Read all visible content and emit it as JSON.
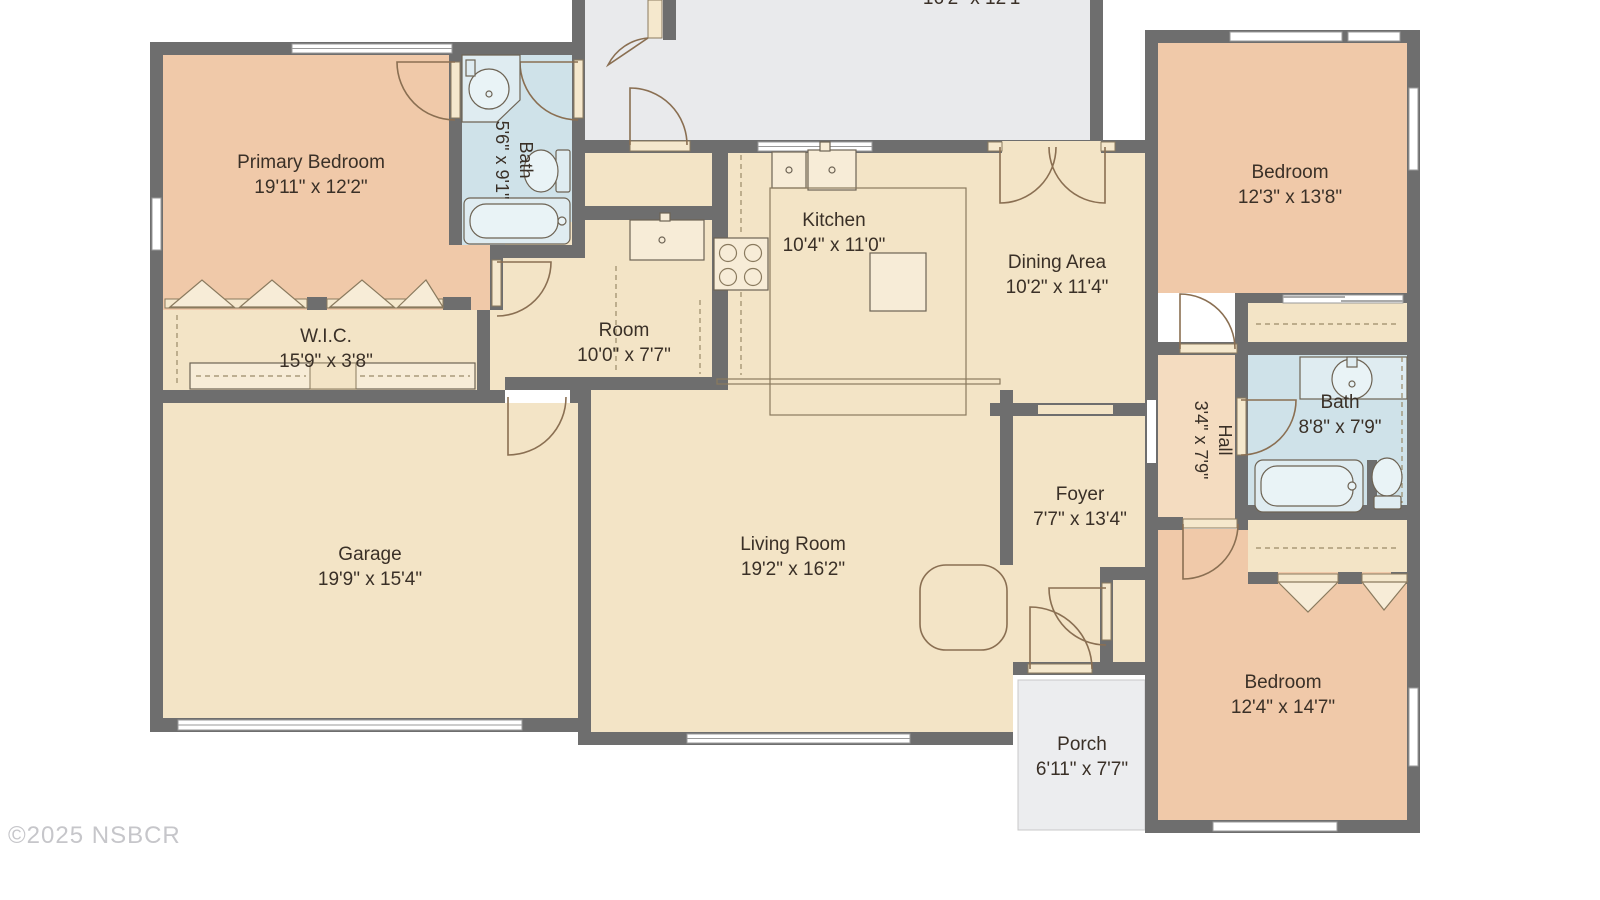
{
  "rooms": {
    "upper_room_partial": {
      "dims": "16'2\" x 12'1\""
    },
    "primary_bedroom": {
      "name": "Primary Bedroom",
      "dims": "19'11\" x 12'2\""
    },
    "bath_1": {
      "name": "Bath",
      "dims": "5'6\" x 9'1\""
    },
    "kitchen": {
      "name": "Kitchen",
      "dims": "10'4\" x 11'0\""
    },
    "dining_area": {
      "name": "Dining Area",
      "dims": "10'2\" x 11'4\""
    },
    "bedroom_2": {
      "name": "Bedroom",
      "dims": "12'3\" x 13'8\""
    },
    "wic": {
      "name": "W.I.C.",
      "dims": "15'9\" x 3'8\""
    },
    "room": {
      "name": "Room",
      "dims": "10'0\" x 7'7\""
    },
    "hall": {
      "name": "Hall",
      "dims": "3'4\" x 7'9\""
    },
    "bath_2": {
      "name": "Bath",
      "dims": "8'8\" x 7'9\""
    },
    "garage": {
      "name": "Garage",
      "dims": "19'9\" x 15'4\""
    },
    "living_room": {
      "name": "Living Room",
      "dims": "19'2\" x 16'2\""
    },
    "foyer": {
      "name": "Foyer",
      "dims": "7'7\" x 13'4\""
    },
    "bedroom_3": {
      "name": "Bedroom",
      "dims": "12'4\" x 14'7\""
    },
    "porch": {
      "name": "Porch",
      "dims": "6'11\" x 7'7\""
    }
  },
  "footer": {
    "copyright": "©2025 NSBCR"
  },
  "colors": {
    "wall": "#6e6e6e",
    "floor_main": "#f3e4c6",
    "floor_bedroom": "#f0c9a9",
    "floor_bath": "#cfe2e9",
    "floor_unlabeled": "#e9eaec",
    "floor_porch": "#ecedef",
    "label_text": "#3a3027",
    "copyright_text": "#c6c6ca"
  }
}
